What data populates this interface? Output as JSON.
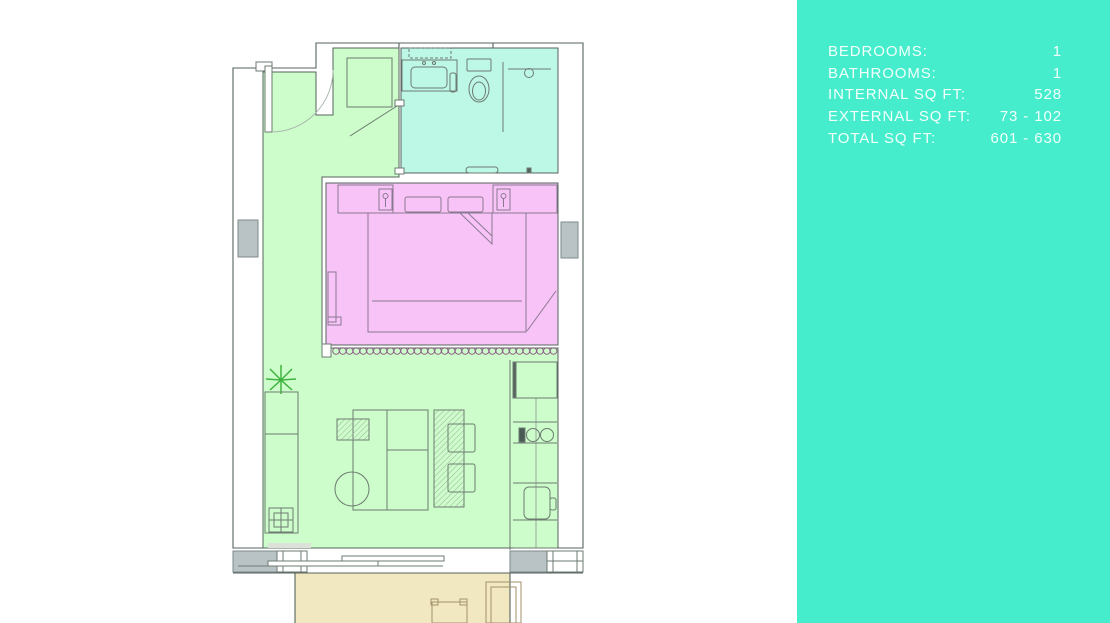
{
  "panel": {
    "background": "#45edcc",
    "text_color": "#ffffff",
    "rows": [
      {
        "label": "BEDROOMS:",
        "value": "1"
      },
      {
        "label": "BATHROOMS:",
        "value": "1"
      },
      {
        "label": "INTERNAL SQ FT:",
        "value": "528"
      },
      {
        "label": "EXTERNAL SQ FT:",
        "value": "73 - 102"
      },
      {
        "label": "TOTAL SQ FT:",
        "value": "601 - 630"
      }
    ]
  },
  "floorplan": {
    "wall_color": "#55635d",
    "furniture_line_color": "#6d7b72",
    "partition_color": "#8d5e86",
    "plant_color": "#3fb33f",
    "column_color": "#b9c3c5",
    "rooms": {
      "living": {
        "name": "living-entry",
        "color": "#cdfdca"
      },
      "bathroom": {
        "name": "bathroom",
        "color": "#bdf7e6"
      },
      "bedroom": {
        "name": "bedroom",
        "color": "#f8c4f8"
      },
      "balcony": {
        "name": "balcony",
        "color": "#f1e8c2"
      }
    }
  }
}
